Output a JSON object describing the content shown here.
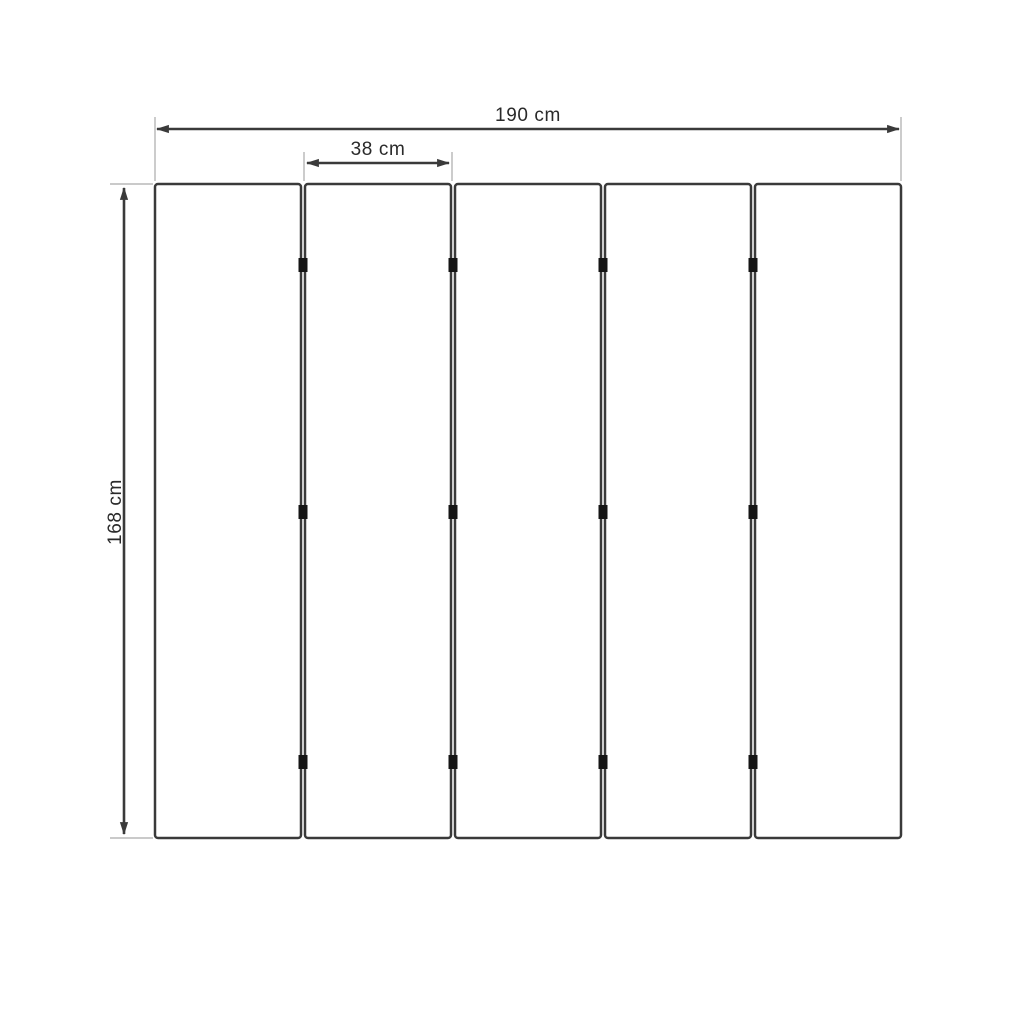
{
  "labels": {
    "total_width": "190 cm",
    "panel_width": "38 cm",
    "height": "168 cm"
  },
  "measurements": {
    "total_width_cm": 190,
    "panel_width_cm": 38,
    "height_cm": 168
  },
  "structure": {
    "panel_count": 5,
    "joint_count": 4,
    "hinges_per_joint": 3
  },
  "colors": {
    "background": "#ffffff",
    "line": "#3a3a3a",
    "extension": "#aaaaaa",
    "text": "#2a2a2a",
    "hinge": "#151515"
  }
}
